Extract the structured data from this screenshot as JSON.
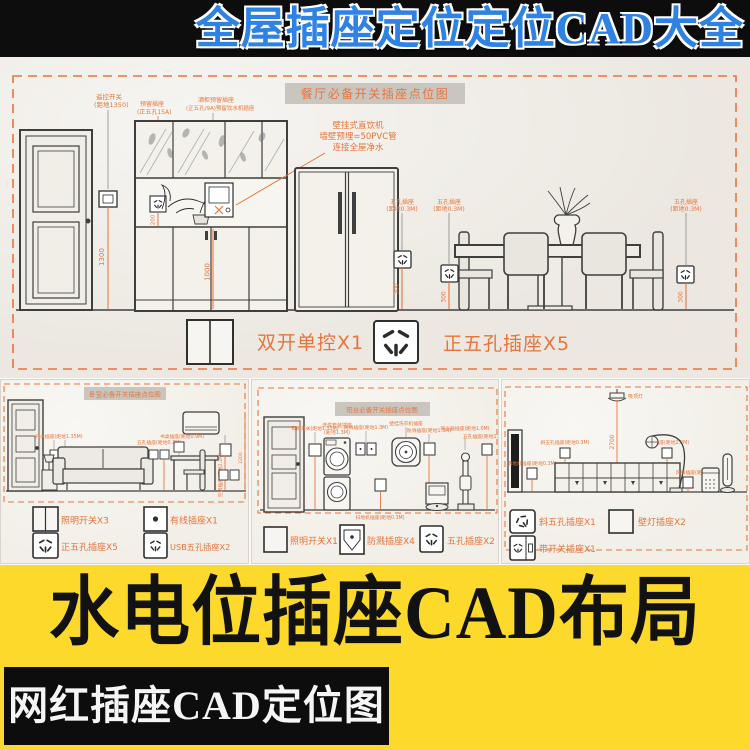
{
  "colors": {
    "accent_orange": "#E8743B",
    "banner_blue": "#2E82E4",
    "banner_yellow": "#FDD92B",
    "paper": "#ECE8E1",
    "cad_line": "#3F3F3F",
    "title_box_gray": "#C9C6C0"
  },
  "top_banner": {
    "title": "全屋插座定位定位CAD大全"
  },
  "main": {
    "title": "餐厅必备开关插座点位图",
    "note": {
      "l1": "壁挂式直饮机",
      "l2": "墙壁预埋=50PVC管",
      "l3": "连接全屋净水"
    },
    "labels": {
      "remote": {
        "l1": "遥控开关",
        "l2": "(距地1350)"
      },
      "cab1": {
        "l1": "预留插座",
        "l2": "(正五孔15A)"
      },
      "cab2": {
        "l1": "酒柜预留插座",
        "l2": "(正五孔/9A)预留饮水机插座"
      },
      "socket": {
        "l1": "五孔插座",
        "l2": "(距地0.3M)"
      }
    },
    "dims": {
      "d1": "1300",
      "d2": "200",
      "d3": "1000",
      "d4": "300"
    },
    "legend": {
      "switch": "双开单控X1",
      "socket": "正五孔插座X5"
    }
  },
  "panel_bedroom": {
    "title": "卧室必备开关插座点位图",
    "labels": {
      "a1": "开关插座(距地1.35M)",
      "a2": "五孔插座(距地0.3M)",
      "a3": "空调插座(距地2.2M)",
      "a4": "书桌插座(距地0.9M)",
      "d1": "300",
      "d2": "2200"
    },
    "legend": {
      "i1": "照明开关X3",
      "i2": "有线插座X1",
      "i3": "正五孔插座X5",
      "i4": "USB五孔插座X2"
    }
  },
  "panel_balcony": {
    "title": "阳台必备开关插座点位图",
    "labels": {
      "a1": "洗烘套装插座",
      "a2": "(距地1.3M)",
      "a3": "防溅插座(距地1.3M)",
      "a4": "壁挂洗衣机插座",
      "a5": "吸尘器插座(距地1.0M)",
      "a6": "扫地机插座(距地0.3M)",
      "a7": "照明开关(距地1.35M)",
      "a8": "五孔插座(距地1.5M)"
    },
    "legend": {
      "i1": "照明开关X1",
      "i2": "防溅插座X4",
      "i3": "五孔插座X2"
    }
  },
  "panel_living": {
    "labels": {
      "a1": "吸顶灯",
      "a2": "2700",
      "a3": "斜五孔插座(距地0.3M)",
      "a4": "落地灯插座(距地0.3M)",
      "a5": "壁灯插座(距地2.2M)",
      "a6": "风扇插座(距地0.3M)"
    },
    "legend": {
      "i1": "斜五孔插座X1",
      "i2": "壁灯插座X2",
      "i3": "带开关插座X1"
    }
  },
  "yellow_banner": {
    "title": "水电位插座CAD布局"
  },
  "bottom_label": {
    "title": "网红插座CAD定位图"
  }
}
